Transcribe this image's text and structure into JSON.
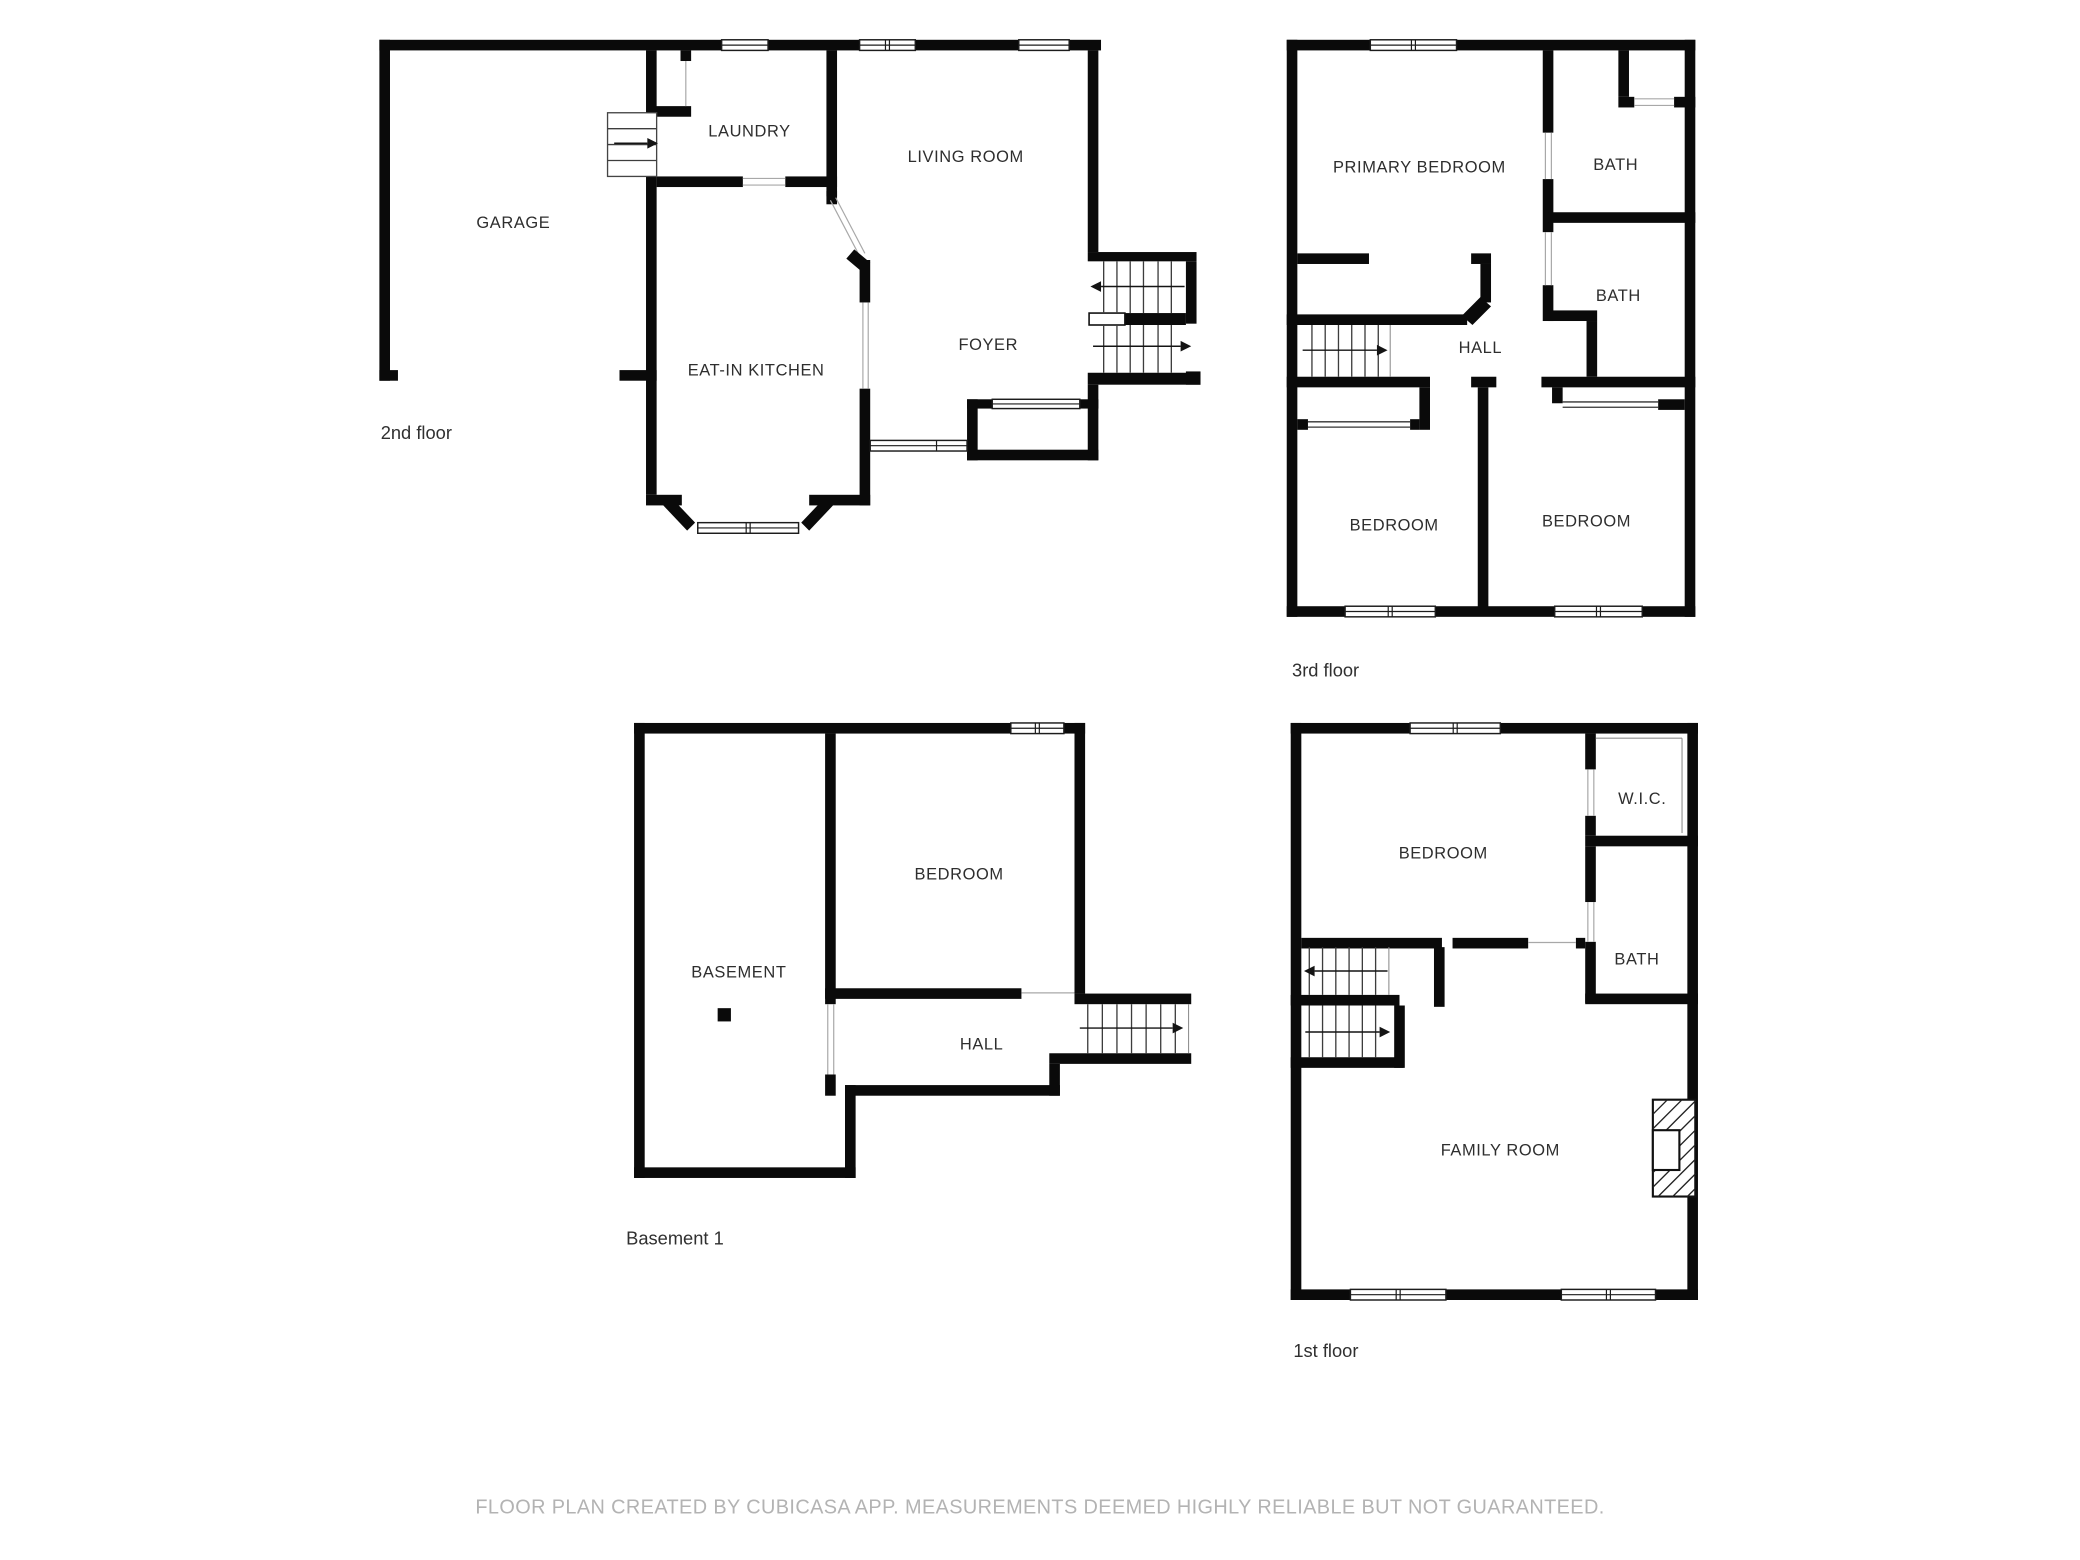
{
  "document": {
    "type": "floor-plan-sheet",
    "footer_text": "FLOOR PLAN CREATED BY CUBICASA APP. MEASUREMENTS DEEMED HIGHLY RELIABLE BUT NOT GUARANTEED."
  },
  "colors": {
    "wall": "#0a0a0a",
    "background": "#ffffff",
    "footer_text": "#b3b3b3",
    "label_text": "#2e2e2e"
  },
  "plans": {
    "floor2": {
      "floor_label": "2nd floor",
      "rooms": {
        "garage": "GARAGE",
        "laundry": "LAUNDRY",
        "living_room": "LIVING ROOM",
        "eat_in_kitchen": "EAT-IN KITCHEN",
        "foyer": "FOYER"
      }
    },
    "floor3": {
      "floor_label": "3rd floor",
      "rooms": {
        "primary_bedroom": "PRIMARY BEDROOM",
        "bath_top": "BATH",
        "bath_mid": "BATH",
        "hall": "HALL",
        "bedroom_left": "BEDROOM",
        "bedroom_right": "BEDROOM"
      }
    },
    "basement": {
      "floor_label": "Basement 1",
      "rooms": {
        "basement": "BASEMENT",
        "bedroom": "BEDROOM",
        "hall": "HALL"
      }
    },
    "floor1": {
      "floor_label": "1st floor",
      "rooms": {
        "bedroom": "BEDROOM",
        "wic": "W.I.C.",
        "bath": "BATH",
        "family_room": "FAMILY ROOM"
      }
    }
  }
}
